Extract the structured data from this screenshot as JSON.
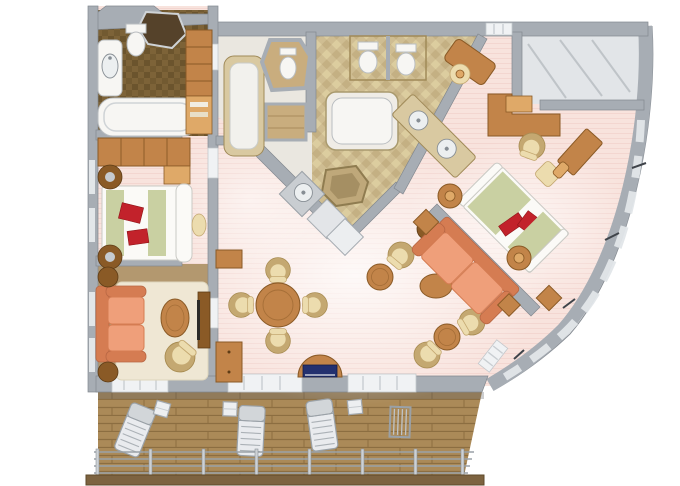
{
  "figure": {
    "type": "floor-plan-3d-render",
    "subject": "Top-down 3D floor plan of a cruise-ship suite with two guest rooms, two bathrooms, living-dining room, master bedroom, walk-in closet and a teak veranda deck with loungers",
    "rooms": [
      "guest-bathroom",
      "guest-bedroom",
      "guest-sitting-room",
      "central-spa",
      "master-bathroom",
      "walk-in-closet",
      "entry-foyer",
      "wet-bar",
      "living-dining-room",
      "master-bedroom",
      "veranda-deck"
    ],
    "furniture": [
      "bathtub",
      "toilet",
      "bidet",
      "double-sink-vanity",
      "shower",
      "whirlpool-tub",
      "double-bed",
      "nightstand",
      "wardrobe",
      "sofa",
      "loveseat",
      "coffee-table",
      "barrel-chair",
      "dining-table",
      "dining-chair",
      "sideboard",
      "tv-cabinet",
      "console-table",
      "writing-desk",
      "vanity-desk",
      "ottoman",
      "deck-lounger",
      "deck-chair",
      "deck-side-table",
      "railing"
    ]
  },
  "palette": {
    "bg": "#ffffff",
    "wall": "#a7adb4",
    "wall-light": "#cdd1d5",
    "wall-dark": "#82888f",
    "carpet": "#f8e3dd",
    "carpet-deep": "#efccc4",
    "floor-spa": "#eae7e0",
    "floor-closet": "#e2e5e8",
    "floor-tan": "#b3986f",
    "rug": "#efe7d4",
    "marble": "#d9c9a1",
    "marble-dark": "#a08a58",
    "marble-floor": "#cfbd92",
    "stone-dark": "#7d6338",
    "stone-deeper": "#5f4a26",
    "wood": "#c28449",
    "wood-light": "#dfa968",
    "wood-dark": "#8a5a26",
    "deck": "#ab8a58",
    "deck-line": "#8c6e41",
    "salmon": "#ef9f7a",
    "salmon-dark": "#d57c52",
    "cream": "#ecdcae",
    "cream-dark": "#c4a871",
    "white": "#f7f6f3",
    "sage": "#c9d0a2",
    "red": "#c2222b",
    "navy": "#23306f",
    "glass": "#e2e6e9",
    "rail": "#9aa1a7",
    "shadow": "#565b60"
  }
}
